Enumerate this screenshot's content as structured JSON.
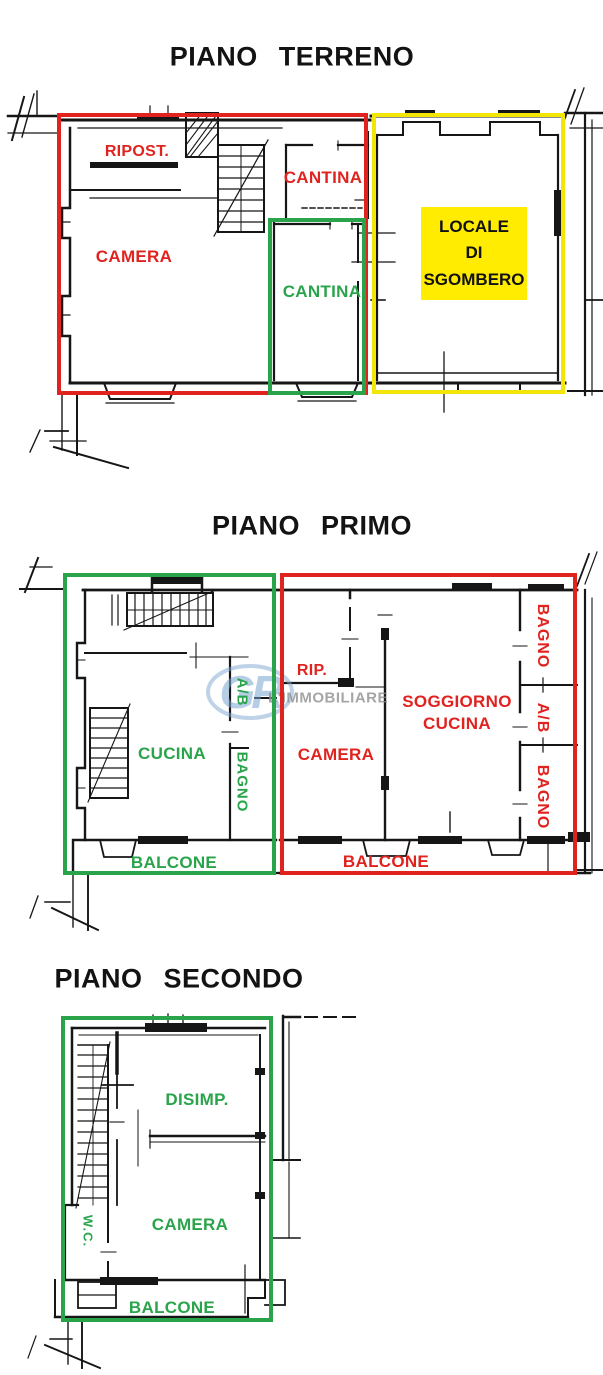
{
  "colors": {
    "red": "#e0231f",
    "green": "#2aa44b",
    "yellow": "#f2e609",
    "yellow_fill": "#ffec00"
  },
  "watermark": {
    "logo": "GR",
    "name": "L'IMMOBILIARE"
  },
  "floors": [
    {
      "title": "PIANO TERRENO",
      "rooms": {
        "ripost": "RIPOST.",
        "camera": "CAMERA",
        "cantina_red": "CANTINA",
        "cantina_green": "CANTINA"
      },
      "locale": {
        "l1": "LOCALE",
        "l2": "DI",
        "l3": "SGOMBERO"
      }
    },
    {
      "title": "PIANO PRIMO",
      "rooms": {
        "rip": "RIP.",
        "camera": "CAMERA",
        "soggiorno_l1": "SOGGIORNO",
        "soggiorno_l2": "CUCINA",
        "balcone_red": "BALCONE",
        "bagno_top_red": "BAGNO",
        "ab_red": "A/B",
        "bagno_bottom_red": "BAGNO",
        "cucina": "CUCINA",
        "ab_green": "A/B",
        "bagno_green": "BAGNO",
        "balcone_green": "BALCONE"
      }
    },
    {
      "title": "PIANO SECONDO",
      "rooms": {
        "disimp": "DISIMP.",
        "camera": "CAMERA",
        "wc": "W.C.",
        "balcone": "BALCONE"
      }
    }
  ]
}
